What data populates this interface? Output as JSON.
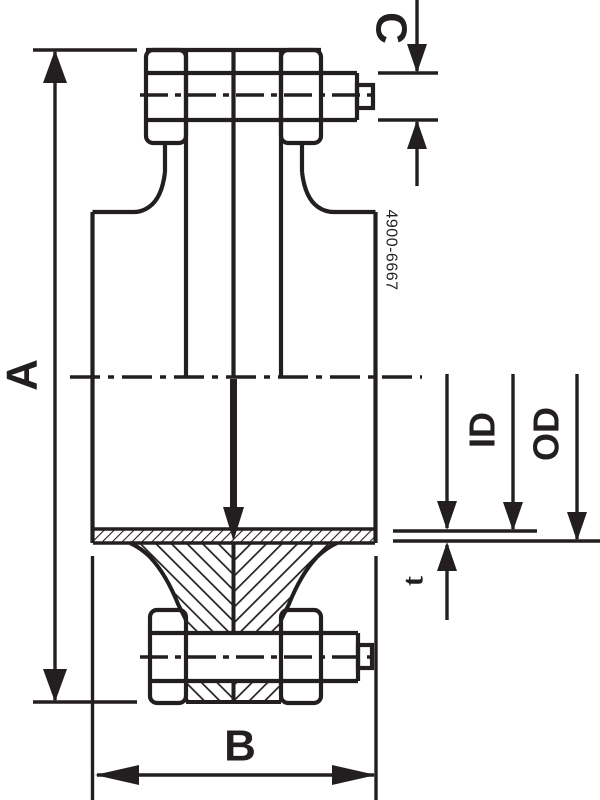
{
  "drawing": {
    "labels": {
      "a": "A",
      "b": "B",
      "c": "C",
      "id": "ID",
      "od": "OD",
      "t": "t"
    },
    "part_number": "4900-6667",
    "colors": {
      "ink": "#231f20",
      "background": "#ffffff"
    }
  }
}
